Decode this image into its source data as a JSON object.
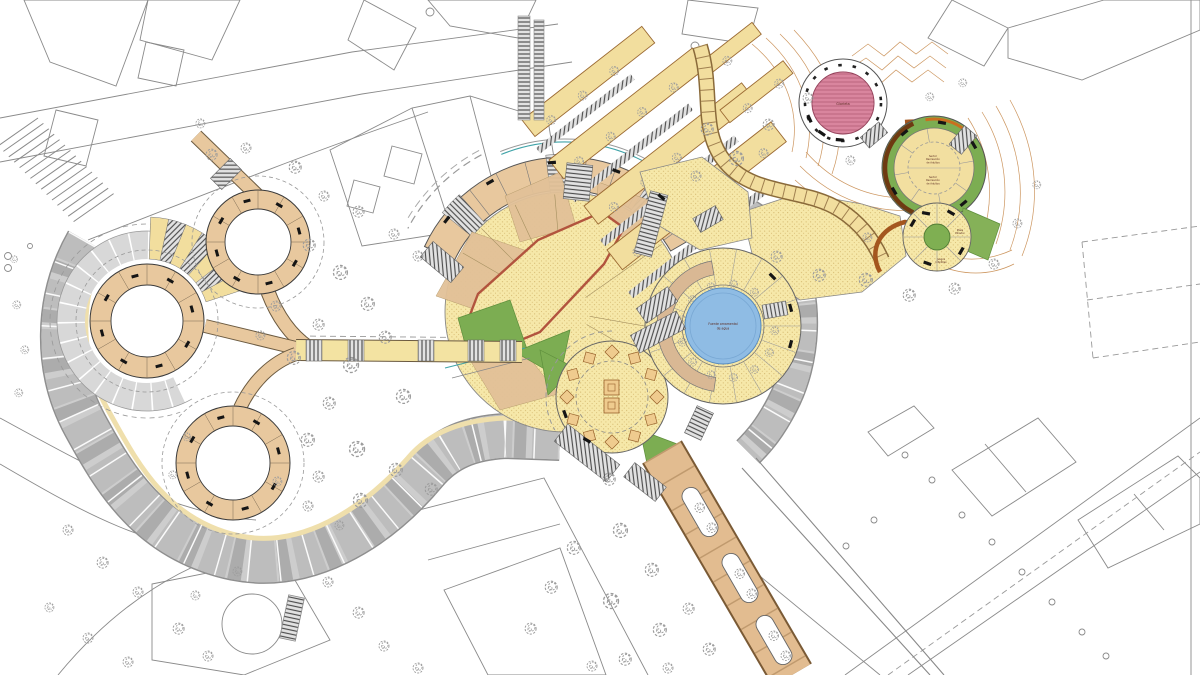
{
  "meta": {
    "type": "architectural-site-plan",
    "description": "Color master plan of a terraced urban park: circular ring plazas, central amphitheatre, ornamental fountain plaza, pink gazebo circle, green recreation circles, tree-lined boulevard and faceted grey promenades over contour terrain"
  },
  "labels": {
    "pink_plaza": "Glorieta",
    "green_upper": [
      "Sector",
      "Recreación",
      "de Adultos"
    ],
    "green_lower": [
      "Sector",
      "Recreación",
      "de Adultos"
    ],
    "fountain": [
      "Fuente ornamental",
      "de agua"
    ],
    "small_east": [
      "Plaza",
      "Mirador"
    ],
    "small_south": [
      "Juegos",
      "Infantiles"
    ]
  },
  "palette": {
    "paper": "#FFFFFF",
    "lineGray": "#8A8A8A",
    "paveYellow": "#F6E8A9",
    "paveDot": "#C9A85B",
    "tan": "#E8C89E",
    "tanDark": "#D9B894",
    "pathTan": "#E2BC90",
    "green": "#7CAD52",
    "greenDark": "#5E8F3C",
    "pink": "#D7708F",
    "blue": "#8FBCE4",
    "promenade": "#CDCDCD",
    "promenadeDark": "#B5B5B5",
    "cream": "#EFDFAC",
    "contour": "#C6894C",
    "ramp": "#A4561E",
    "rampDark": "#6E3A12",
    "treeGray": "#9C9C9C",
    "ink": "#333333",
    "stair": "#4D4D4D",
    "redEdge": "#B2543E"
  }
}
